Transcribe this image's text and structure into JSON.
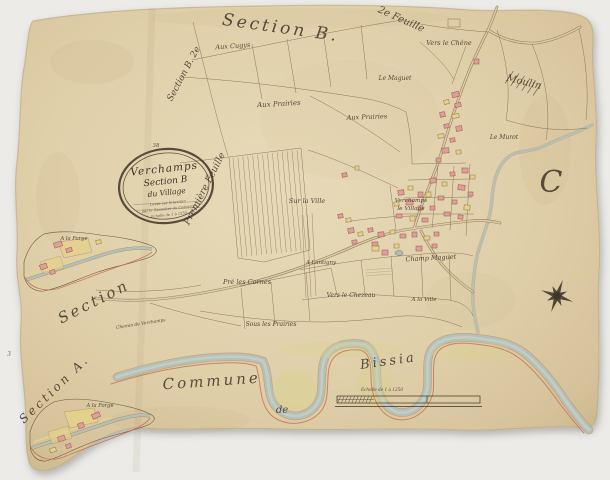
{
  "map": {
    "sheet_number": "38",
    "cartouche": {
      "line1": "Verchamps",
      "line2": "Section B",
      "line3": "du Village",
      "note1": "Levée sur le terrain",
      "note2": "par le Géomètre du Cadastre",
      "note3": "Echelle de 1 à 1250"
    },
    "labels": {
      "section_top": "Section B.",
      "edge_top_right": "2e Feuille",
      "edge_left_upper": "Section B. 2e",
      "edge_left_lower": "Première Feuille",
      "aux_cugys": "Aux Cugys",
      "vers_le_chene": "Vers le Chêne",
      "le_maguet": "Le Maguet",
      "aux_prairies_w": "Aux Prairies",
      "aux_prairies_e": "Aux Prairies",
      "le_murot": "Le Murot",
      "letter_c": "C",
      "sur_la_ville": "Sur la Ville",
      "village_name": "Verchamps",
      "village_sub": "le Village",
      "champ_maguet": "Champ Maguet",
      "a_lantigny": "A Lantigny",
      "pre_les_cornes": "Pré les Cornes",
      "vers_le_chezeau": "Vers le Chezeau",
      "a_la_ville": "A la Ville",
      "sous_les_prairies": "Sous les Prairies",
      "section_mid": "Section",
      "chemin": "Chemin de Verchamps",
      "section_a": "Section A.",
      "forge_top": "A la Forge",
      "forge_bottom": "A la Forge",
      "commune": "Commune",
      "de": "de",
      "bissia": "Bissia",
      "moulin": "Moulin",
      "numeral_3": "3",
      "scale_caption": "Echelle de 1 à 1250"
    },
    "icons": {
      "compass_rose": "8-pointed-star"
    },
    "colors": {
      "background": "#ecebe8",
      "paper": "#dccaa4",
      "paper-light": "#e8dab9",
      "paper-edge": "#b5a077",
      "ink": "#6f5940",
      "ink-dark": "#3f3328",
      "water": "#b4c1b9",
      "water-edge": "#c49a74",
      "pink": "#dca09a",
      "pink-edge": "#a8625a",
      "yellow": "#e5d18c",
      "yellow-edge": "#9a8350",
      "red-line": "#c4704d",
      "meadow": "#d9d28e"
    }
  }
}
